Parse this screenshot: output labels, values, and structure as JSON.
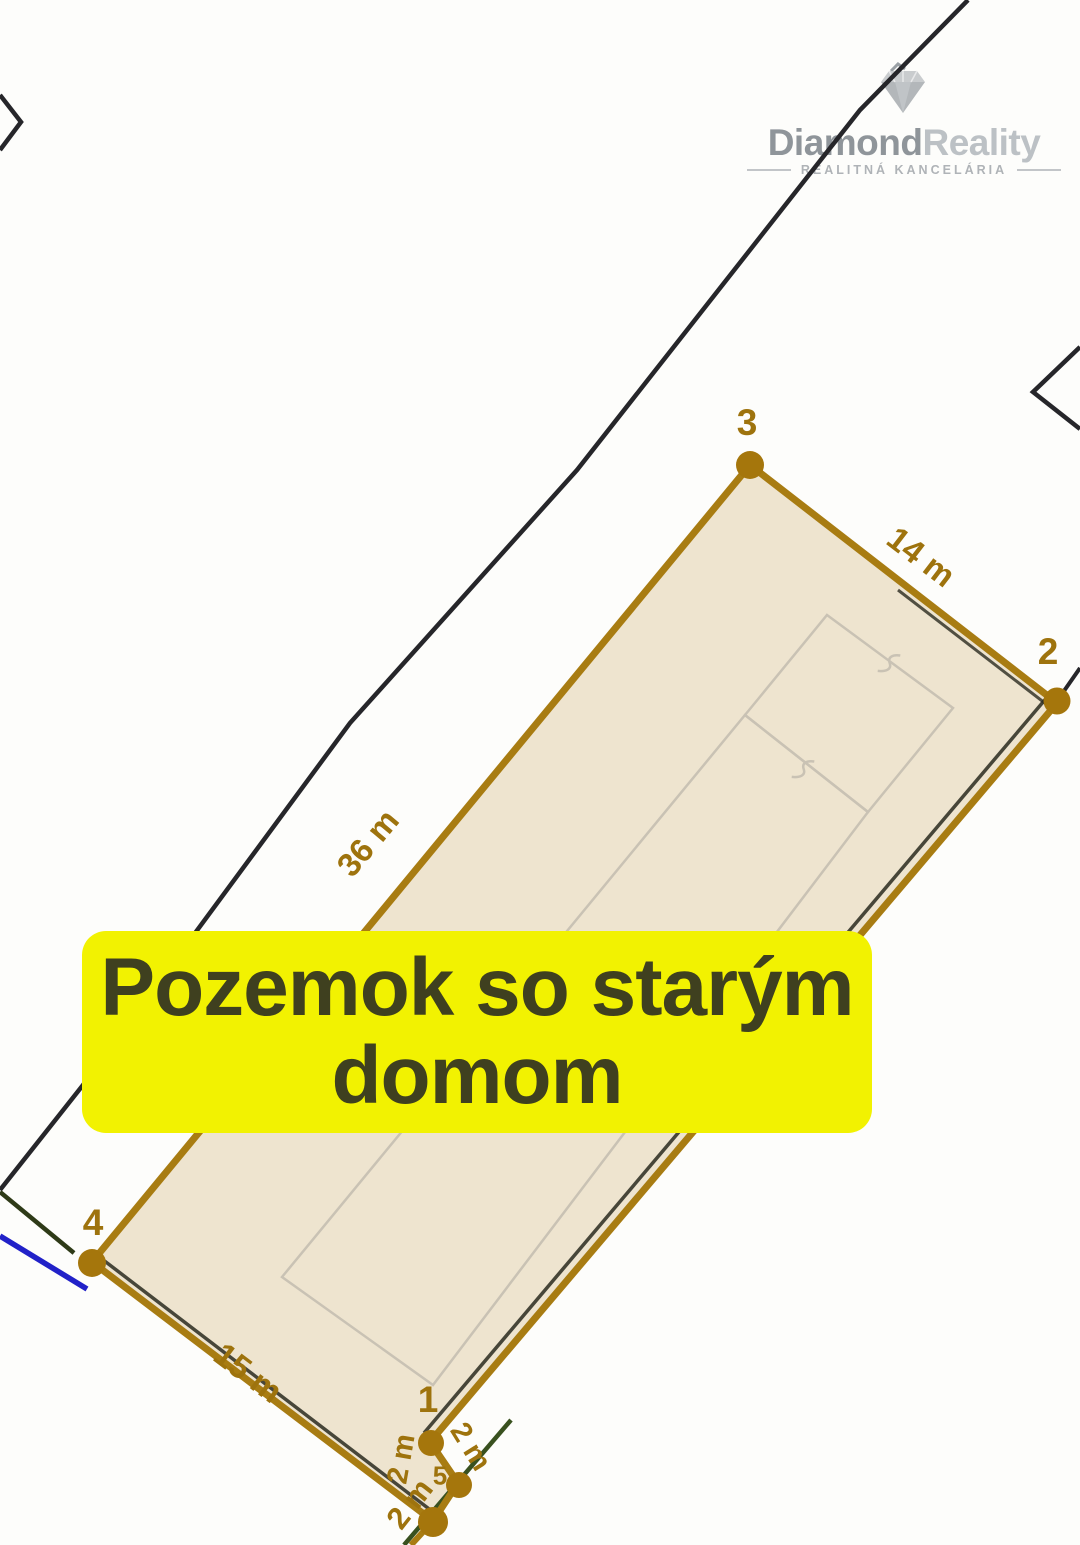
{
  "logo": {
    "brand_primary": "Diamond",
    "brand_secondary": "Reality",
    "tagline": "REALITNÁ KANCELÁRIA"
  },
  "banner": {
    "line1": "Pozemok so starým",
    "line2": "domom",
    "bg_color": "#F2F201",
    "text_color": "#3F401F"
  },
  "map": {
    "corner_labels": {
      "c1": "1",
      "c2": "2",
      "c3": "3",
      "c4": "4",
      "c5": "5"
    },
    "measurements": {
      "top_edge": "14 m",
      "left_edge": "36 m",
      "bottom_edge": "15 m",
      "small_a": "2 m",
      "small_b": "2 m",
      "small_c": "2 m"
    },
    "colors": {
      "parcel_fill": "#EEE4CF",
      "boundary_gold": "#A87C12",
      "label_gold": "#9E730D",
      "dot_gold": "#A5760C",
      "neighbor_boundary_black": "#26262A",
      "utility_line_blue": "#2121C8",
      "boundary_green": "#39511F",
      "building_outline_gray": "#C9C2B4"
    }
  }
}
